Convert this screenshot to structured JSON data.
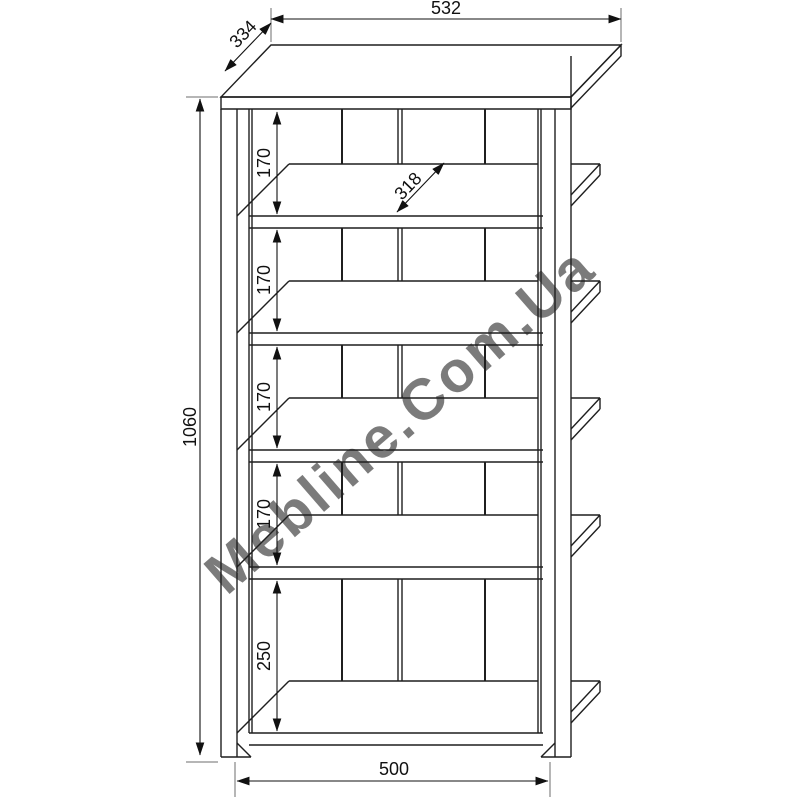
{
  "watermark": {
    "text": "Mebline.Com.Ua"
  },
  "dims": {
    "top_width": "532",
    "depth": "334",
    "height": "1060",
    "gaps": [
      "170",
      "170",
      "170",
      "170",
      "250"
    ],
    "shelf_depth": "318",
    "bottom_width": "500"
  },
  "colors": {
    "line": "#1f1f1f",
    "dim": "#111111",
    "ext": "#6e6e6e",
    "watermark": "#c6c6c6",
    "background": "#ffffff"
  }
}
